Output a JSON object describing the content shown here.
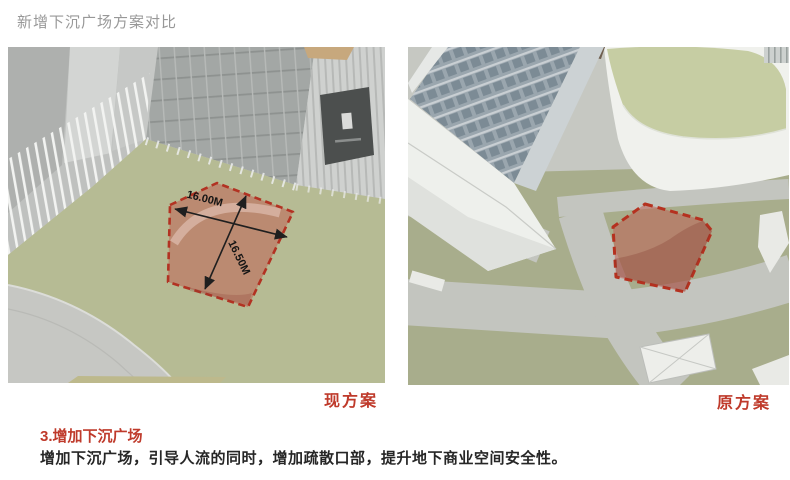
{
  "page": {
    "title": "新增下沉广场方案对比"
  },
  "panels": [
    {
      "caption": "现方案",
      "annotations": {
        "dim_width": "16.00M",
        "dim_depth": "16.50M"
      }
    },
    {
      "caption": "原方案"
    }
  ],
  "notes": {
    "heading": "3.增加下沉广场",
    "body": "增加下沉广场，引导人流的同时，增加疏散口部，提升地下商业空间安全性。"
  },
  "colors": {
    "accent_red": "#bf3a2b",
    "highlight_fill": "#c05a4e",
    "highlight_border": "#b23222",
    "plaza_green": "#b6bb94",
    "roof_green": "#c6cda3",
    "road_gray": "#c4c6c0",
    "title_gray": "#989898",
    "dimension_text": "#1a1a1a"
  }
}
